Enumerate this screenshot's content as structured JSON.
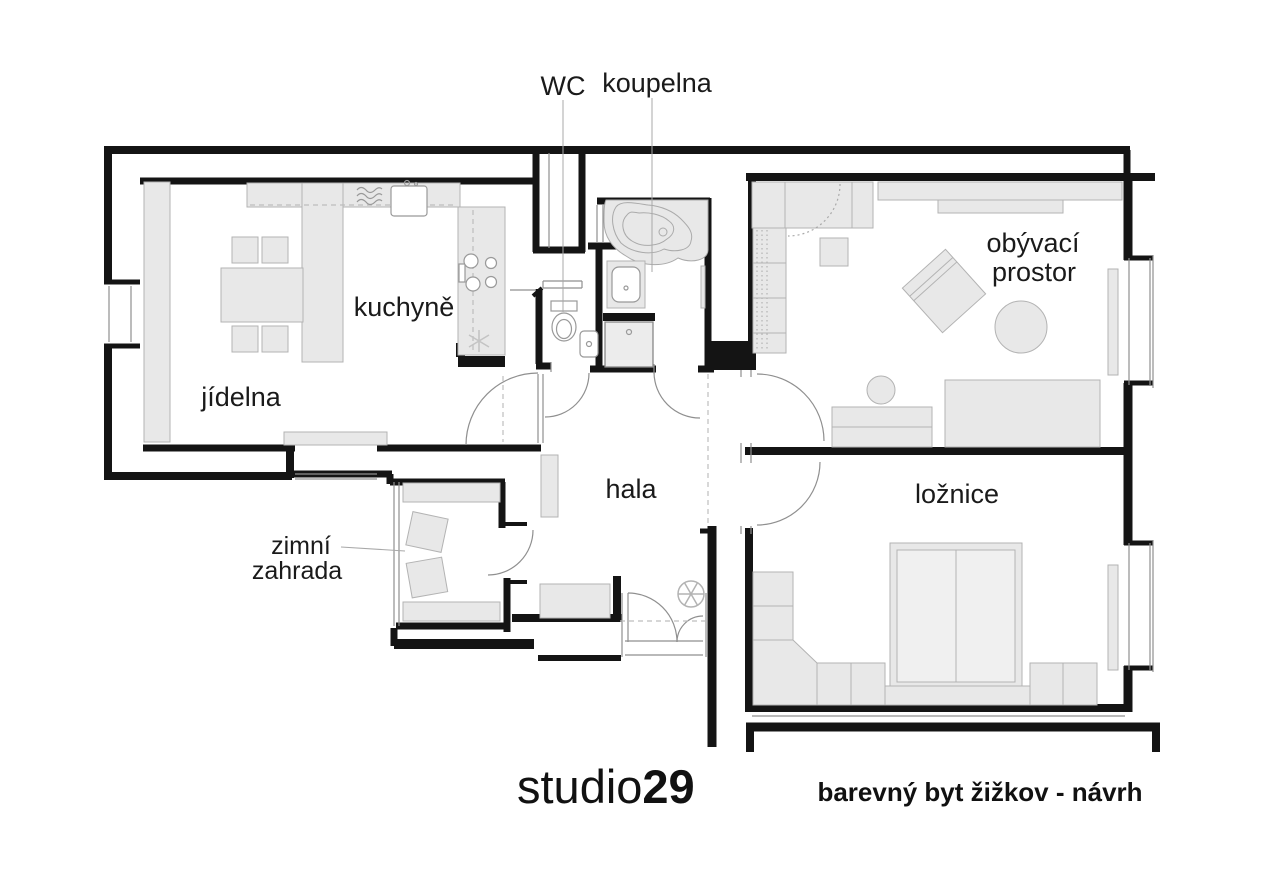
{
  "plan": {
    "annotations": {
      "wc_label": "WC",
      "bathroom_label": "koupelna"
    },
    "rooms": {
      "kitchen": "kuchyně",
      "dining": "jídelna",
      "hall": "hala",
      "living_line1": "obývací",
      "living_line2": "prostor",
      "bedroom": "ložnice",
      "winter_garden_line1": "zimní",
      "winter_garden_line2": "zahrada"
    },
    "symbols": {
      "ceiling_light": "ceiling-light-icon",
      "kitchen_marker": "star-marker-icon"
    },
    "colors": {
      "wall": "#141414",
      "furniture_fill": "#e8e8e8",
      "furniture_stroke": "#b3b3b3",
      "thin_line": "#8f8f8f",
      "leader_line": "#a8a8a8",
      "text": "#1a1a1a"
    }
  },
  "footer": {
    "logo_regular": "studio",
    "logo_bold": "29",
    "project_title": "barevný byt žižkov - návrh"
  }
}
